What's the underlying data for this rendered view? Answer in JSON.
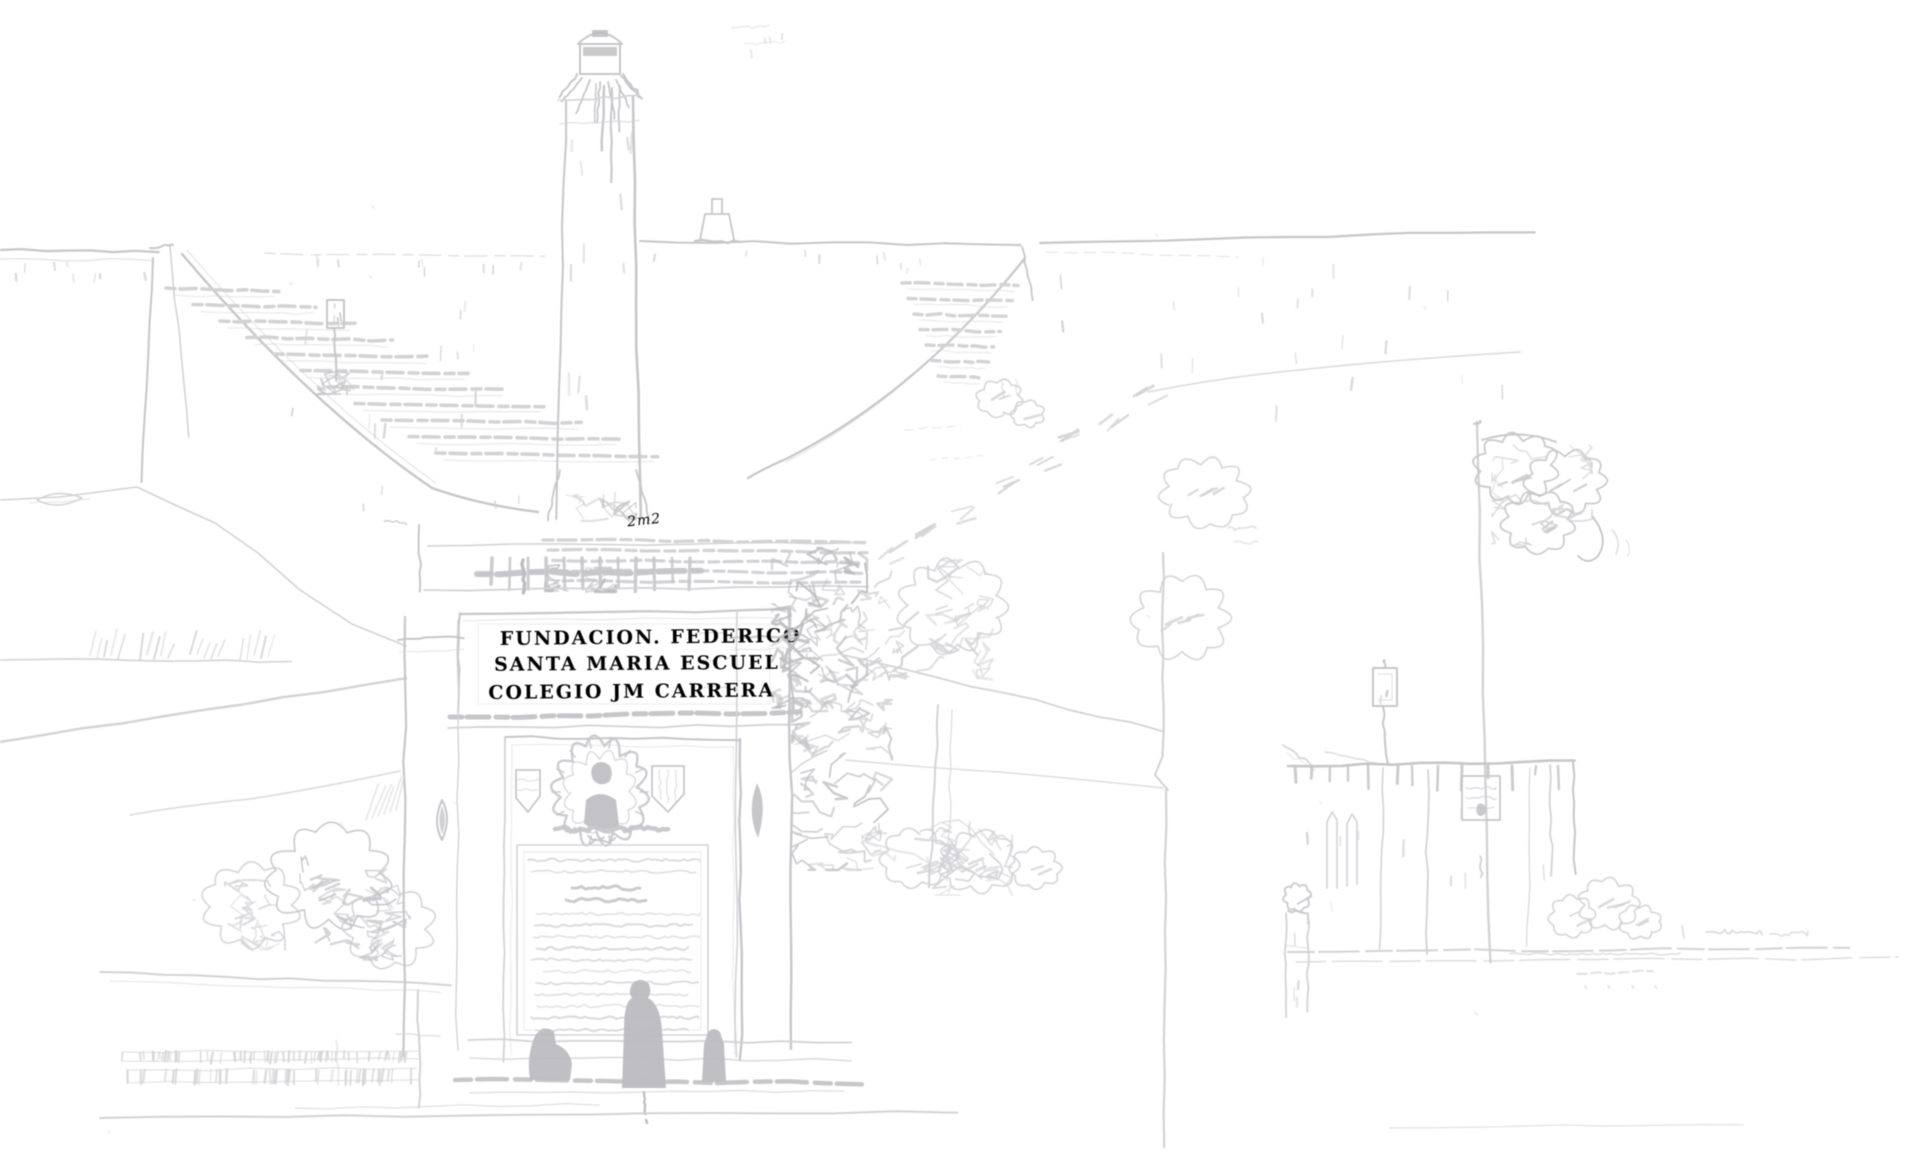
{
  "artwork": {
    "inscription": {
      "line1": "FUNDACION. FEDERICO",
      "line2": "SANTA MARIA ESCUEL",
      "line3": "COLEGIO JM CARRERA"
    },
    "annotation": "2m2",
    "colors": {
      "background": "#ffffff",
      "faint": "#e0e0e4",
      "main": "#d3d3d7",
      "dark": "#c7c7cb",
      "ink": "#bdbdc1",
      "text": "#c6c6ca"
    }
  }
}
